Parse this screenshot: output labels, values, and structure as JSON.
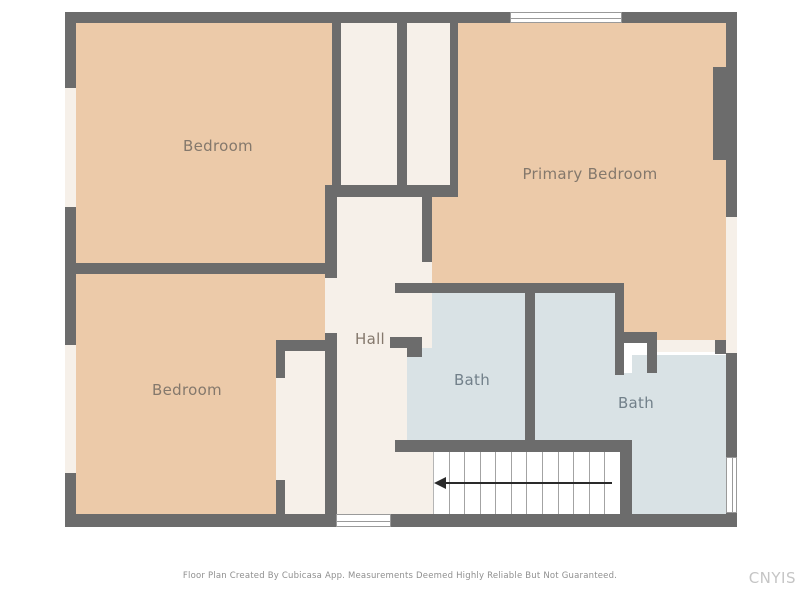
{
  "plan": {
    "title": "Second floor residential floor plan",
    "rooms": [
      {
        "name": "bedroom-top-left",
        "label": "Bedroom"
      },
      {
        "name": "bedroom-bottom-left",
        "label": "Bedroom"
      },
      {
        "name": "primary-bedroom",
        "label": "Primary Bedroom"
      },
      {
        "name": "hall",
        "label": "Hall"
      },
      {
        "name": "bath-left",
        "label": "Bath"
      },
      {
        "name": "bath-right",
        "label": "Bath"
      }
    ],
    "stairs": {
      "treads": 12,
      "direction": "left"
    }
  },
  "colors": {
    "background": "#ffffff",
    "wall": "#6c6c6c",
    "floor_tan": "#eccaa9",
    "floor_cream": "#f6f0e9",
    "floor_bath": "#d9e2e5",
    "stairs_white": "#ffffff",
    "outline": "#9a9a9a",
    "label_warm": "#84786c",
    "label_cool": "#72808a",
    "arrow": "#2a2a2a",
    "footer_text": "#8f8f8f",
    "watermark": "#c5c5c5"
  },
  "footer": {
    "disclaimer": "Floor Plan Created By Cubicasa App. Measurements Deemed Highly Reliable But Not Guaranteed.",
    "watermark": "CNYIS"
  }
}
